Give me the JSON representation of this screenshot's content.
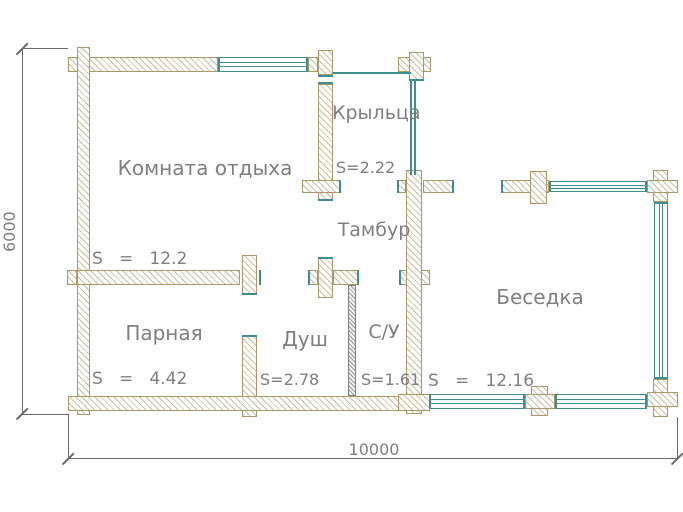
{
  "colors": {
    "teal": "#3d8f8f",
    "wall-border": "#ab9767",
    "wall-hatch": "#c9c0ab",
    "partition-line": "#7f7f7f",
    "text": "#7f7f7f",
    "dim-line": "#6a6a6a"
  },
  "plan": {
    "rooms": [
      {
        "name": "Комната отдыха",
        "area": "S   =   12.2"
      },
      {
        "name": "Крыльца",
        "area": "S=2.22"
      },
      {
        "name": "Тамбур"
      },
      {
        "name": "Парная",
        "area": "S   =   4.42"
      },
      {
        "name": "Душ",
        "area": "S=2.78"
      },
      {
        "name": "С/У",
        "area": "S=1.61"
      },
      {
        "name": "Беседка",
        "area": "S   =   12.16"
      }
    ],
    "dimensions": {
      "vertical": "6000",
      "horizontal": "10000"
    }
  }
}
